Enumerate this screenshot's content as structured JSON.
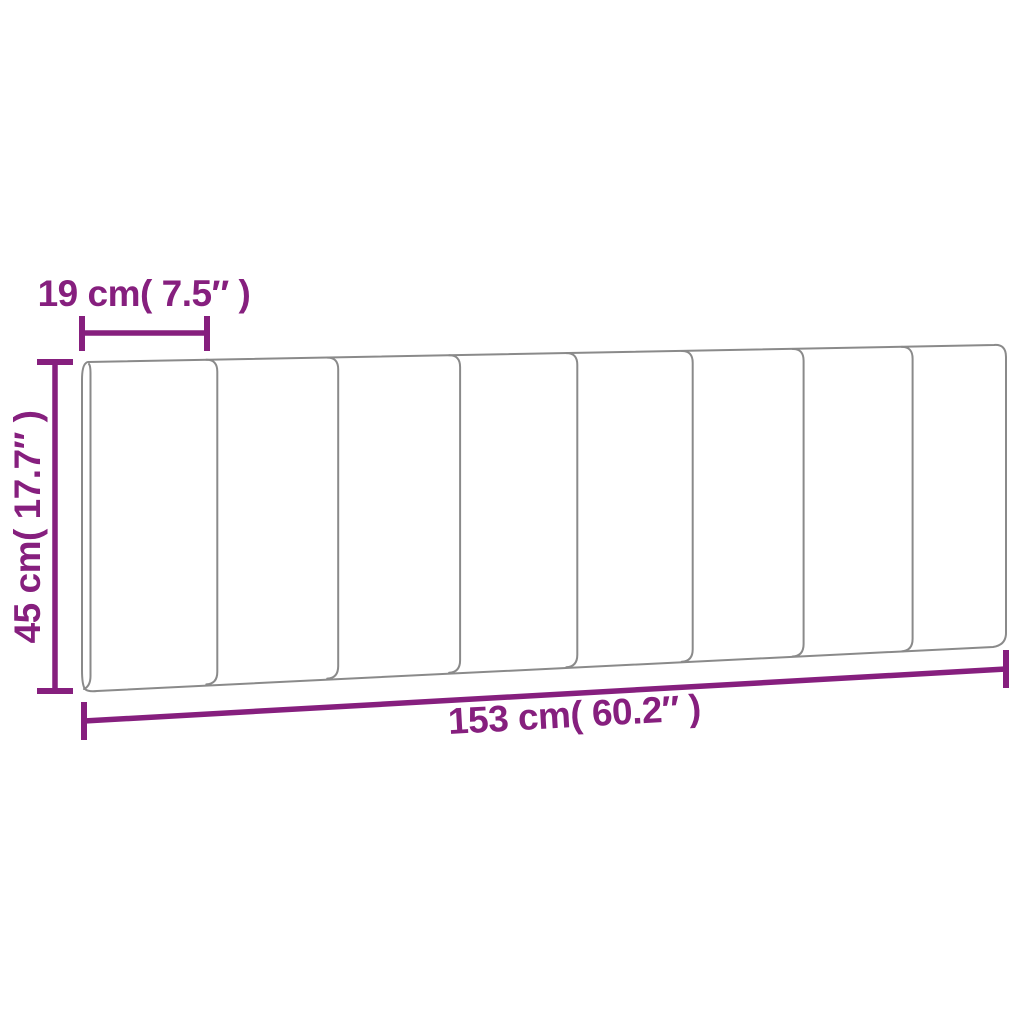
{
  "diagram": {
    "subject": "headboard-cushion-dimensions",
    "panel_count": 8,
    "colors": {
      "dimension": "#861F7E",
      "outline": "#8A8A8A",
      "background": "#FFFFFF"
    },
    "dimensions": {
      "segment_width": {
        "label": "19 cm( 7.5″ )",
        "cm": 19,
        "inches": 7.5
      },
      "height": {
        "label": "45 cm( 17.7″ )",
        "cm": 45,
        "inches": 17.7
      },
      "total_width": {
        "label": "153 cm( 60.2″ )",
        "cm": 153,
        "inches": 60.2
      }
    }
  }
}
